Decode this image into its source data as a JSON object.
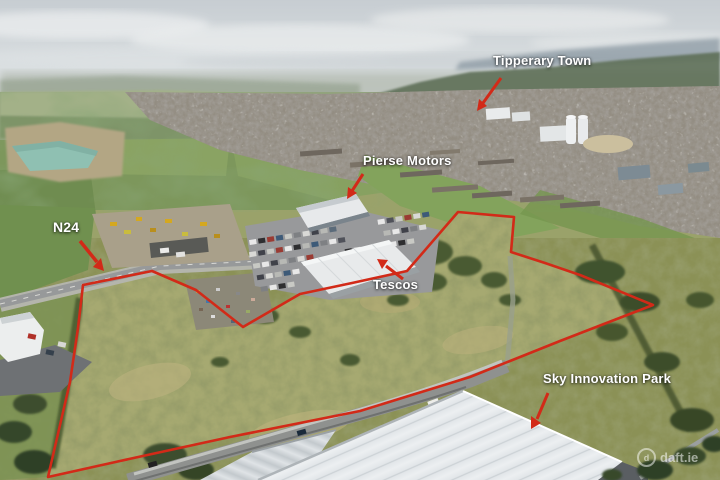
{
  "annotations": [
    {
      "id": "tipperary-town",
      "label": "Tipperary Town",
      "arrow_line": "501,78 483,103",
      "arrow_head": "477,111 487,106 479,99"
    },
    {
      "id": "pierse-motors",
      "label": "Pierse Motors",
      "arrow_line": "363,174 352,191",
      "arrow_head": "347,199 357,193 348,187"
    },
    {
      "id": "n24",
      "label": "N24",
      "arrow_line": "80,241 97,262",
      "arrow_head": "104,271 93,267 101,258"
    },
    {
      "id": "tescos",
      "label": "Tescos",
      "arrow_line": "403,279 386,266",
      "arrow_head": "377,259 388,260 382,269"
    },
    {
      "id": "sky-innovation-park",
      "label": "Sky Innovation Park",
      "arrow_line": "548,393 537,419",
      "arrow_head": "531,429 541,423 531,416"
    }
  ],
  "site_boundary": {
    "points": "83,285 152,271 196,290 243,327 300,294 352,283 407,271 458,212 514,217 511,252 545,263 580,275 653,305 560,341 470,377 360,411 230,437 120,461 48,477 60,425 70,382 78,328",
    "color": "#d22a18"
  },
  "watermark": {
    "logo_glyph": "d",
    "text": "daft.ie"
  },
  "colors": {
    "annotation_red": "#d22a18",
    "label_text": "#ffffff"
  }
}
